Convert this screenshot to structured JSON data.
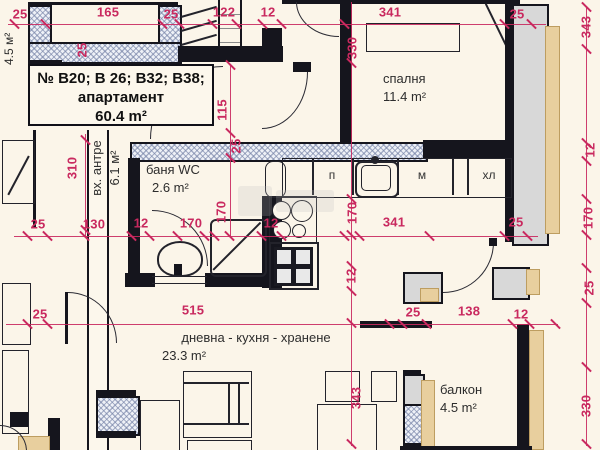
{
  "plan": {
    "colors": {
      "background": "#fbf5e9",
      "wall": "#15151d",
      "dimension_red": "#c9295f",
      "insulation_tan": "#e8cf9e",
      "concrete_gray": "#d8d8d8",
      "hatch_fill": "#eef1f7"
    },
    "apartment_box": {
      "line1": "№ В20; В 26; В32; В38;",
      "line2": "апартамент",
      "line3": "60.4 m²"
    },
    "rooms": {
      "bedroom": {
        "name": "спалня",
        "area": "11.4 m²"
      },
      "bathroom": {
        "name": "баня WC",
        "area": "2.6 m²"
      },
      "entry": {
        "name": "вх. антре",
        "area": "6.1 м²"
      },
      "living": {
        "name": "дневна - кухня - хранене",
        "area": "23.3 m²"
      },
      "balcony": {
        "name": "балкон",
        "area": "4.5 m²"
      },
      "neighbor_balcony": {
        "area": "4.5 м²"
      }
    },
    "kitchen_labels": {
      "washer": "п",
      "dishwasher": "м",
      "fridge": "хл"
    },
    "dimensions": [
      {
        "v": "25",
        "x": 20,
        "y": 14
      },
      {
        "v": "165",
        "x": 108,
        "y": 12
      },
      {
        "v": "25",
        "x": 171,
        "y": 14
      },
      {
        "v": "122",
        "x": 224,
        "y": 12
      },
      {
        "v": "12",
        "x": 268,
        "y": 12
      },
      {
        "v": "341",
        "x": 390,
        "y": 12
      },
      {
        "v": "25",
        "x": 517,
        "y": 14
      },
      {
        "v": "330",
        "x": 352,
        "y": 48,
        "r": 1
      },
      {
        "v": "343",
        "x": 586,
        "y": 27,
        "r": 1
      },
      {
        "v": "12",
        "x": 590,
        "y": 150,
        "r": 1
      },
      {
        "v": "170",
        "x": 588,
        "y": 218,
        "r": 1
      },
      {
        "v": "25",
        "x": 589,
        "y": 288,
        "r": 1
      },
      {
        "v": "330",
        "x": 586,
        "y": 406,
        "r": 1
      },
      {
        "v": "25",
        "x": 82,
        "y": 50,
        "r": 1
      },
      {
        "v": "115",
        "x": 222,
        "y": 110,
        "r": 1
      },
      {
        "v": "25",
        "x": 236,
        "y": 146,
        "r": 1
      },
      {
        "v": "310",
        "x": 72,
        "y": 168,
        "r": 1
      },
      {
        "v": "25",
        "x": 38,
        "y": 224
      },
      {
        "v": "130",
        "x": 94,
        "y": 224
      },
      {
        "v": "12",
        "x": 141,
        "y": 223
      },
      {
        "v": "170",
        "x": 191,
        "y": 223
      },
      {
        "v": "170",
        "x": 221,
        "y": 212,
        "r": 1
      },
      {
        "v": "12",
        "x": 271,
        "y": 223
      },
      {
        "v": "170",
        "x": 352,
        "y": 213,
        "r": 1
      },
      {
        "v": "341",
        "x": 394,
        "y": 222
      },
      {
        "v": "25",
        "x": 516,
        "y": 222
      },
      {
        "v": "12",
        "x": 351,
        "y": 276,
        "r": 1
      },
      {
        "v": "25",
        "x": 40,
        "y": 314
      },
      {
        "v": "515",
        "x": 193,
        "y": 310
      },
      {
        "v": "25",
        "x": 413,
        "y": 312
      },
      {
        "v": "138",
        "x": 469,
        "y": 311
      },
      {
        "v": "12",
        "x": 521,
        "y": 314
      },
      {
        "v": "343",
        "x": 356,
        "y": 398,
        "r": 1
      }
    ],
    "ticks": [
      [
        14,
        24
      ],
      [
        45,
        24
      ],
      [
        162,
        24
      ],
      [
        179,
        24
      ],
      [
        212,
        24
      ],
      [
        236,
        24
      ],
      [
        262,
        24
      ],
      [
        281,
        24
      ],
      [
        344,
        24
      ],
      [
        504,
        24
      ],
      [
        531,
        24
      ],
      [
        27,
        236
      ],
      [
        47,
        236
      ],
      [
        84,
        236
      ],
      [
        131,
        236
      ],
      [
        149,
        236
      ],
      [
        177,
        236
      ],
      [
        204,
        236
      ],
      [
        214,
        236
      ],
      [
        229,
        236
      ],
      [
        261,
        236
      ],
      [
        281,
        236
      ],
      [
        344,
        236
      ],
      [
        359,
        236
      ],
      [
        429,
        236
      ],
      [
        504,
        236
      ],
      [
        527,
        236
      ],
      [
        27,
        324
      ],
      [
        47,
        324
      ],
      [
        389,
        324
      ],
      [
        402,
        324
      ],
      [
        426,
        324
      ],
      [
        512,
        324
      ],
      [
        529,
        324
      ],
      [
        555,
        324
      ],
      [
        351,
        63
      ],
      [
        351,
        199
      ],
      [
        351,
        235
      ],
      [
        351,
        266
      ],
      [
        351,
        291
      ],
      [
        351,
        323
      ],
      [
        351,
        444
      ],
      [
        586,
        7
      ],
      [
        586,
        49
      ],
      [
        586,
        143
      ],
      [
        586,
        161
      ],
      [
        586,
        199
      ],
      [
        586,
        235
      ],
      [
        586,
        268
      ],
      [
        586,
        303
      ],
      [
        586,
        367
      ],
      [
        586,
        444
      ],
      [
        230,
        65
      ],
      [
        230,
        133
      ],
      [
        230,
        158
      ],
      [
        85,
        140
      ],
      [
        85,
        230
      ]
    ]
  }
}
